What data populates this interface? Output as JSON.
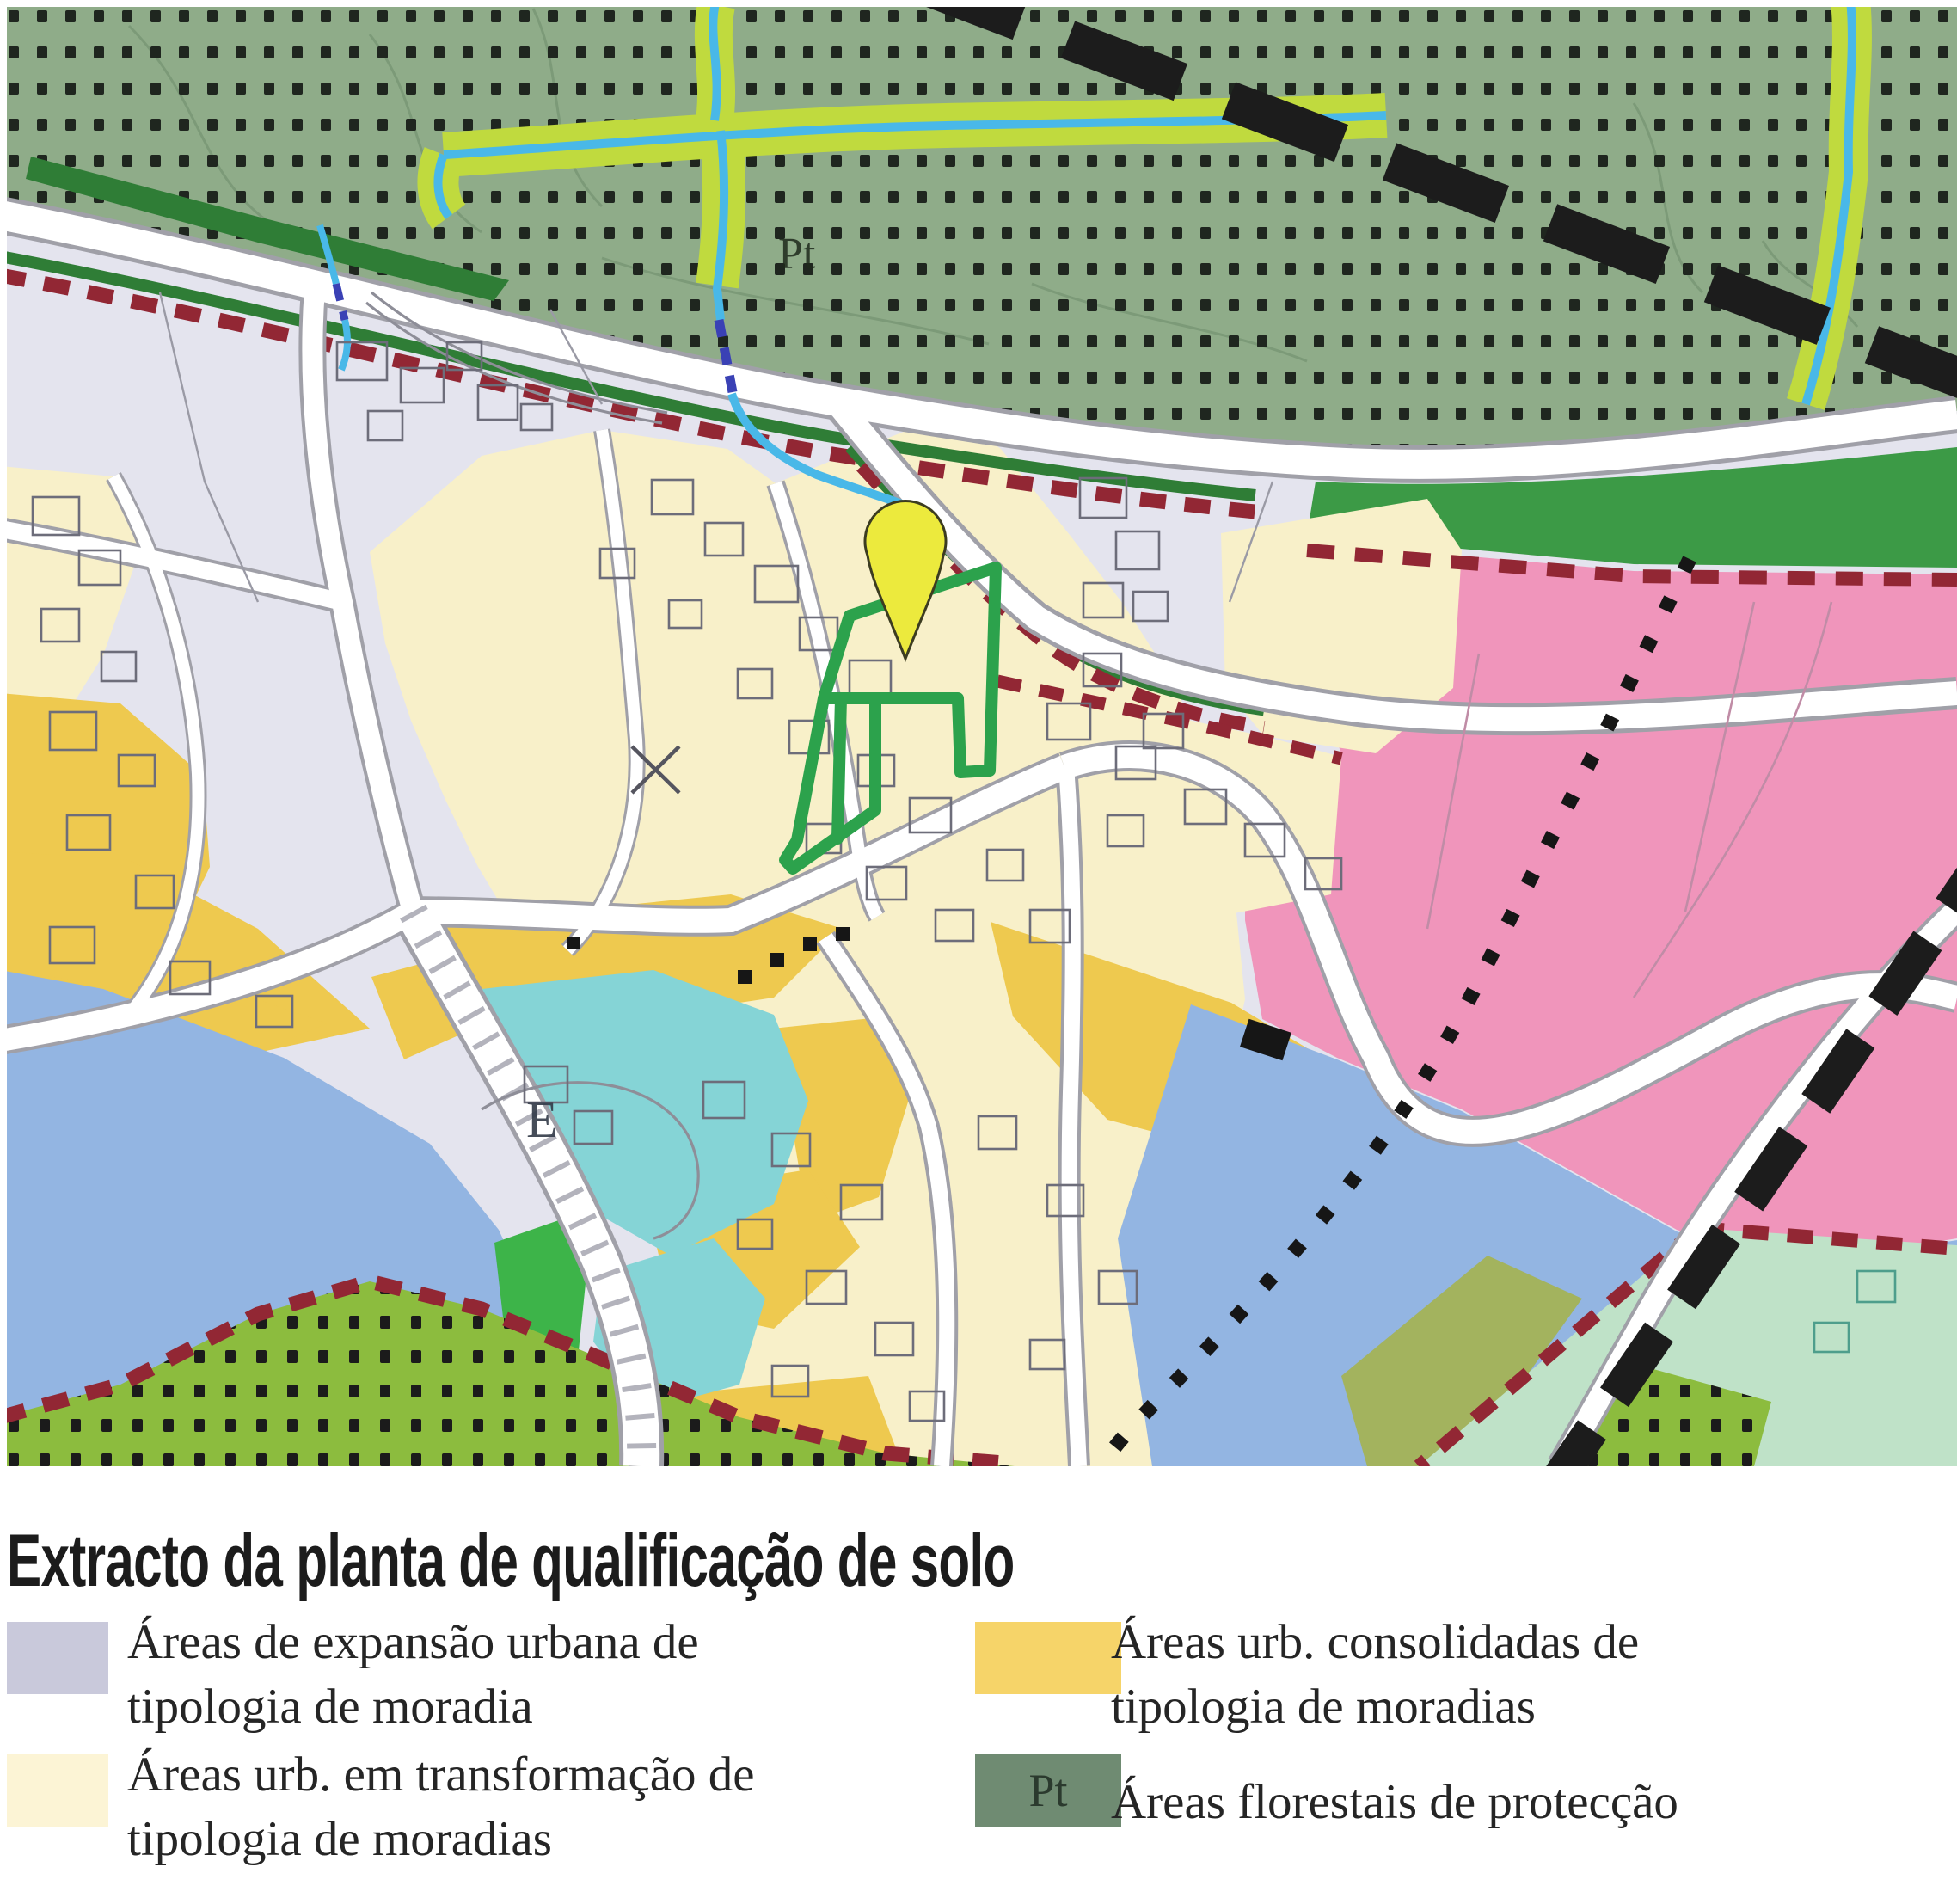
{
  "title": "Extracto da planta de qualificação de solo",
  "map": {
    "pt_label": "Pt",
    "e_label": "E"
  },
  "legend": {
    "items": [
      {
        "swatch_style": "background:#c9c9db",
        "code": "",
        "lines": [
          "Áreas de expansão urbana de",
          "tipologia de moradia"
        ]
      },
      {
        "swatch_style": "background:#fcf4d5",
        "code": "",
        "lines": [
          "Áreas urb. em transformação de",
          "tipologia de moradias"
        ]
      },
      {
        "swatch_style": "background:#f6d469",
        "code": "",
        "lines": [
          "Áreas urb. consolidadas de",
          "tipologia de moradias"
        ]
      },
      {
        "swatch_style": "background:#6f8b72",
        "code": "Pt",
        "lines": [
          "Áreas florestais de protecção"
        ]
      }
    ]
  },
  "colors": {
    "expansion_lavender": "#e4e4ee",
    "transformation_cream": "#f8f0c9",
    "consolidated_gold": "#eec94f",
    "forest_sage": "#8fac89",
    "solid_green": "#3c9a46",
    "boundary_green_band": "#2f7d36",
    "boundary_red_dash": "#922734",
    "pink_zone": "#f095bb",
    "blue_zone": "#93b5e2",
    "cyan_zone": "#85d4d6",
    "mint_zone": "#bfe2c8",
    "olive_zone": "#a3b35e",
    "lime_forest": "#8cbc3e",
    "stream_blue": "#49b8e8",
    "stream_buffer_lime": "#c0da3e",
    "culvert_blue": "#3a41b5",
    "road_white": "#ffffff",
    "parcel_outline_green": "#2ca24c",
    "pin_yellow": "#ecea3d",
    "dash_black": "#1c1c1c"
  }
}
